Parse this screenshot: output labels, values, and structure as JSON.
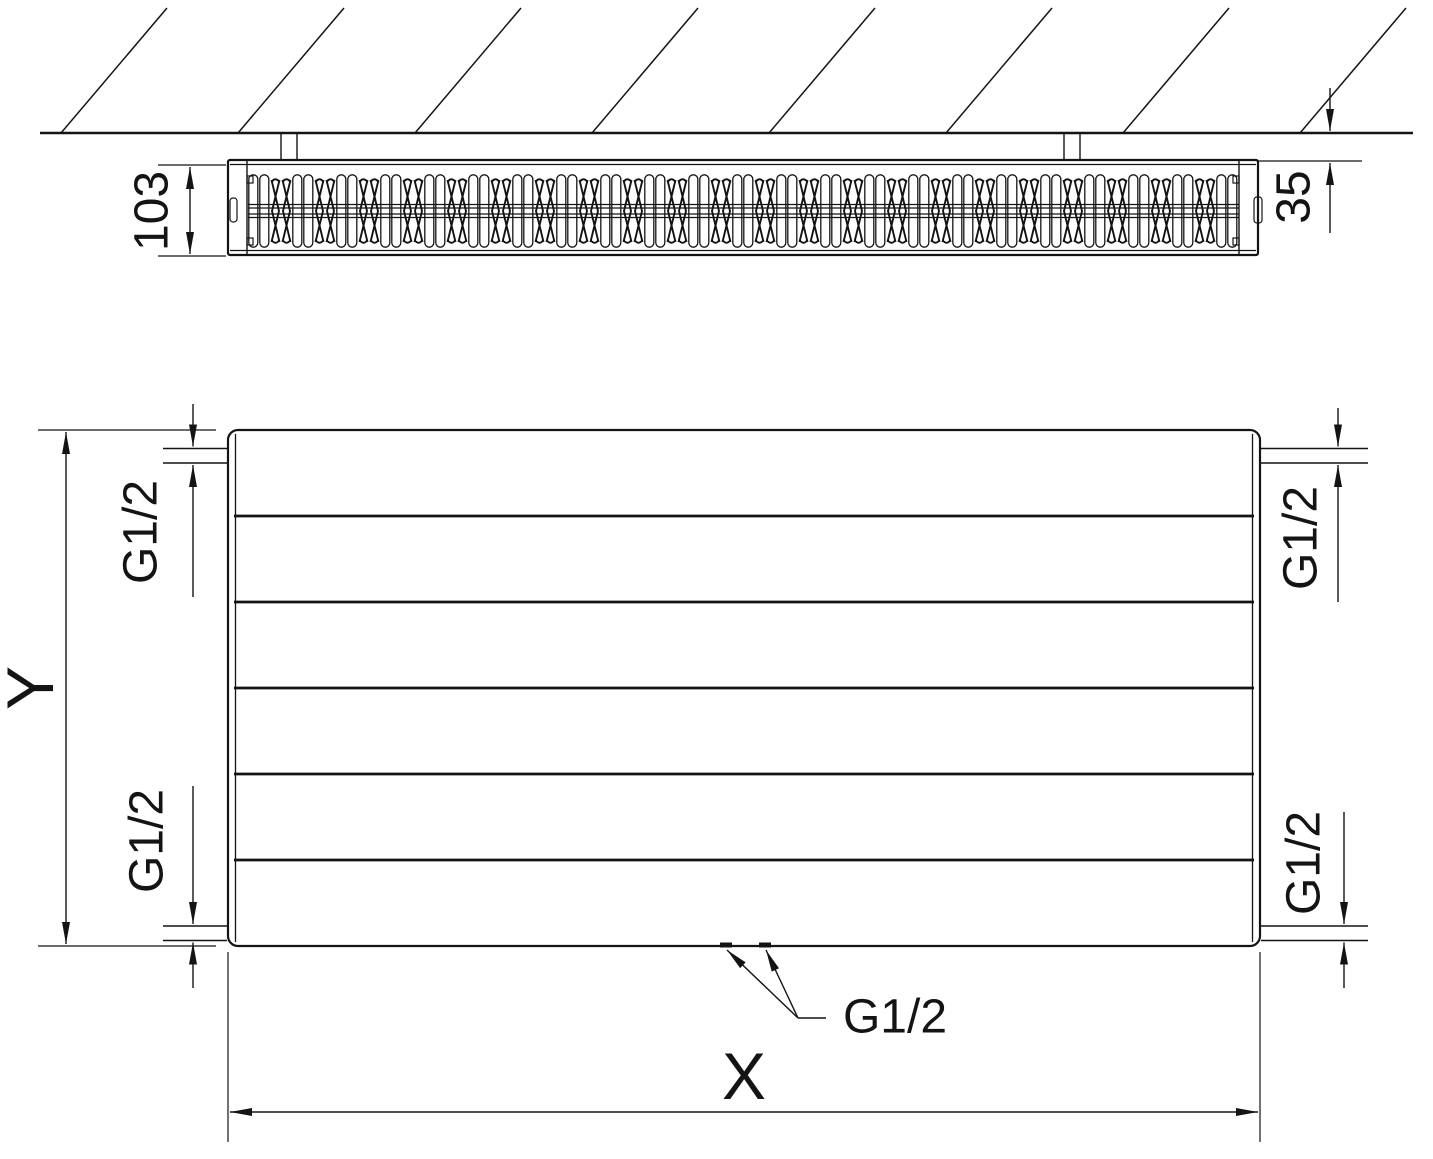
{
  "colors": {
    "ink": "#141414",
    "background": "#ffffff"
  },
  "top_view": {
    "depth_label": "103",
    "wall_distance_label": "35"
  },
  "front_view": {
    "height_label": "Y",
    "width_label": "X",
    "thread_top_left": "G1/2",
    "thread_top_right": "G1/2",
    "thread_bottom_left": "G1/2",
    "thread_bottom_right": "G1/2",
    "thread_bottom_center": "G1/2"
  }
}
